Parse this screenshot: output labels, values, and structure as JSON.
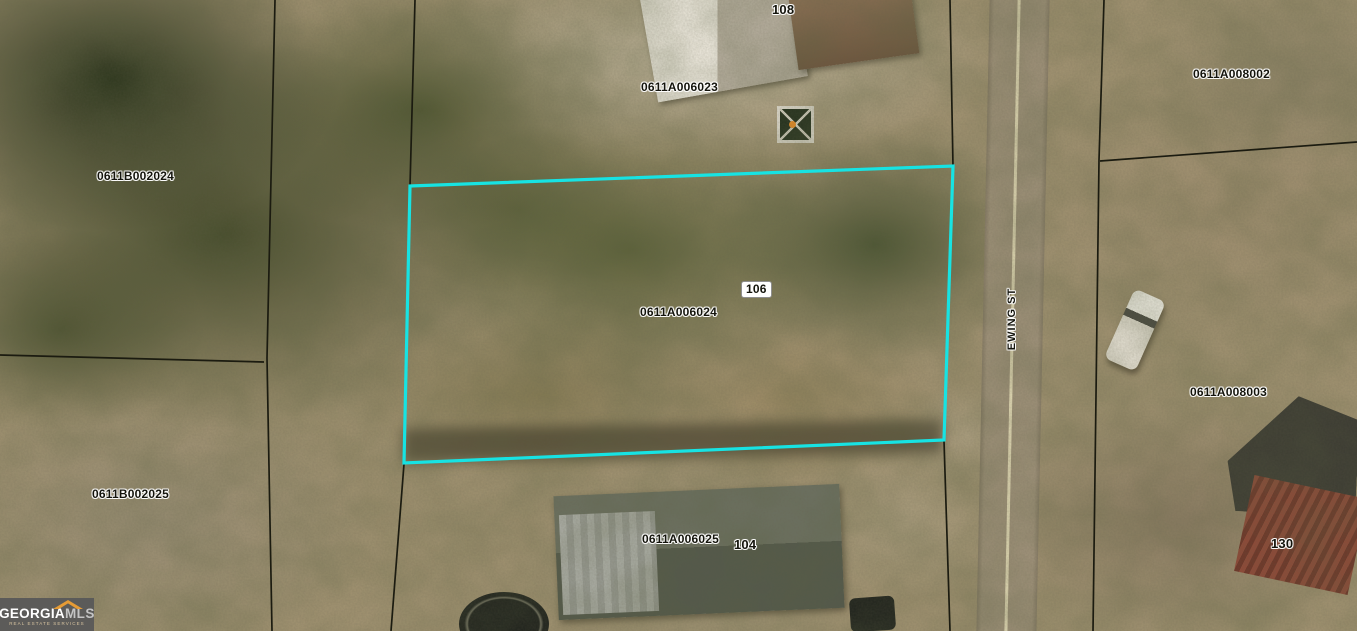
{
  "map": {
    "labels": {
      "house_108": "108",
      "parcel_0611A006023": "0611A006023",
      "parcel_0611B002024": "0611B002024",
      "parcel_0611A008002": "0611A008002",
      "house_106": "106",
      "parcel_0611A006024": "0611A006024",
      "street": "EWING ST",
      "parcel_0611A008003": "0611A008003",
      "parcel_0611B002025": "0611B002025",
      "parcel_0611A006025": "0611A006025",
      "house_104": "104",
      "house_130": "130"
    },
    "highlighted_parcel": {
      "id": "0611A006024",
      "house_number": "106"
    },
    "colors": {
      "highlight_outline": "#17e3e3",
      "parcel_line": "#1b1b10",
      "road_centerline": "#ece4bd"
    }
  },
  "logo": {
    "brand_primary": "GEORGIA",
    "brand_secondary": "MLS",
    "tagline": "REAL ESTATE SERVICES"
  }
}
